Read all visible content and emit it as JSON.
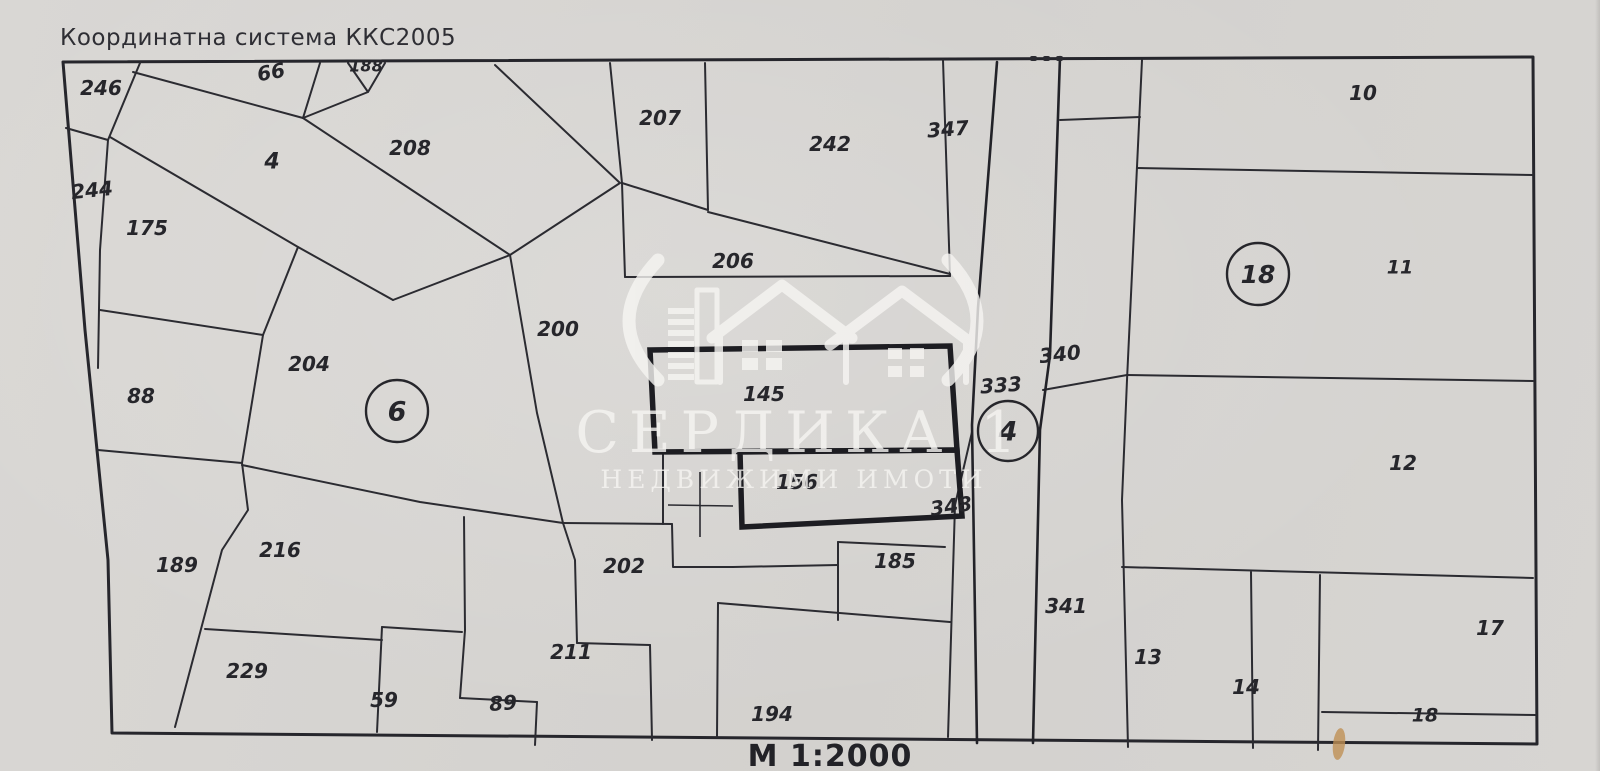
{
  "title": "Координатна система ККС2005",
  "scale": {
    "label": "М 1:2000"
  },
  "watermark": {
    "brand": "СЕРДИКА 1",
    "tagline": "НЕДВИЖИМИ ИМОТИ"
  },
  "colors": {
    "paper": "#d6d4d1",
    "ink": "#2b2b31",
    "watermark": "#f6f5f2",
    "stain": "#bf9055"
  },
  "map": {
    "parcel_labels": [
      {
        "text": "246",
        "x": 101,
        "y": 88
      },
      {
        "text": "66",
        "x": 271,
        "y": 72,
        "rot": -10
      },
      {
        "text": "188",
        "x": 366,
        "y": 66,
        "size": 16
      },
      {
        "text": "4",
        "x": 272,
        "y": 161,
        "size": 22
      },
      {
        "text": "208",
        "x": 410,
        "y": 148
      },
      {
        "text": "207",
        "x": 660,
        "y": 118
      },
      {
        "text": "242",
        "x": 830,
        "y": 144
      },
      {
        "text": "347",
        "x": 948,
        "y": 129,
        "rot": -4
      },
      {
        "text": "244",
        "x": 92,
        "y": 190,
        "rot": -6
      },
      {
        "text": "175",
        "x": 147,
        "y": 228
      },
      {
        "text": "206",
        "x": 733,
        "y": 261
      },
      {
        "text": "200",
        "x": 558,
        "y": 329
      },
      {
        "text": "204",
        "x": 309,
        "y": 364
      },
      {
        "text": "88",
        "x": 141,
        "y": 396
      },
      {
        "text": "145",
        "x": 764,
        "y": 394,
        "size": 20
      },
      {
        "text": "333",
        "x": 1001,
        "y": 385,
        "rot": -4
      },
      {
        "text": "340",
        "x": 1060,
        "y": 354,
        "rot": -6
      },
      {
        "text": "10",
        "x": 1363,
        "y": 93
      },
      {
        "text": "11",
        "x": 1400,
        "y": 267,
        "size": 19
      },
      {
        "text": "12",
        "x": 1403,
        "y": 463
      },
      {
        "text": "156",
        "x": 797,
        "y": 482
      },
      {
        "text": "348",
        "x": 951,
        "y": 506,
        "rot": -8
      },
      {
        "text": "189",
        "x": 177,
        "y": 565
      },
      {
        "text": "216",
        "x": 280,
        "y": 550
      },
      {
        "text": "202",
        "x": 624,
        "y": 566
      },
      {
        "text": "185",
        "x": 895,
        "y": 561
      },
      {
        "text": "341",
        "x": 1066,
        "y": 606
      },
      {
        "text": "229",
        "x": 247,
        "y": 671
      },
      {
        "text": "211",
        "x": 571,
        "y": 652
      },
      {
        "text": "59",
        "x": 384,
        "y": 700
      },
      {
        "text": "89",
        "x": 503,
        "y": 703,
        "rot": -4
      },
      {
        "text": "194",
        "x": 772,
        "y": 714
      },
      {
        "text": "13",
        "x": 1148,
        "y": 657
      },
      {
        "text": "14",
        "x": 1246,
        "y": 687
      },
      {
        "text": "17",
        "x": 1490,
        "y": 628
      },
      {
        "text": "18",
        "x": 1425,
        "y": 715,
        "size": 19
      }
    ],
    "circled_parcels": [
      {
        "text": "6",
        "x": 397,
        "y": 411,
        "r": 31,
        "size": 27
      },
      {
        "text": "4",
        "x": 1008,
        "y": 431,
        "r": 30,
        "size": 27
      },
      {
        "text": "18",
        "x": 1258,
        "y": 274,
        "r": 31,
        "size": 25
      }
    ]
  }
}
